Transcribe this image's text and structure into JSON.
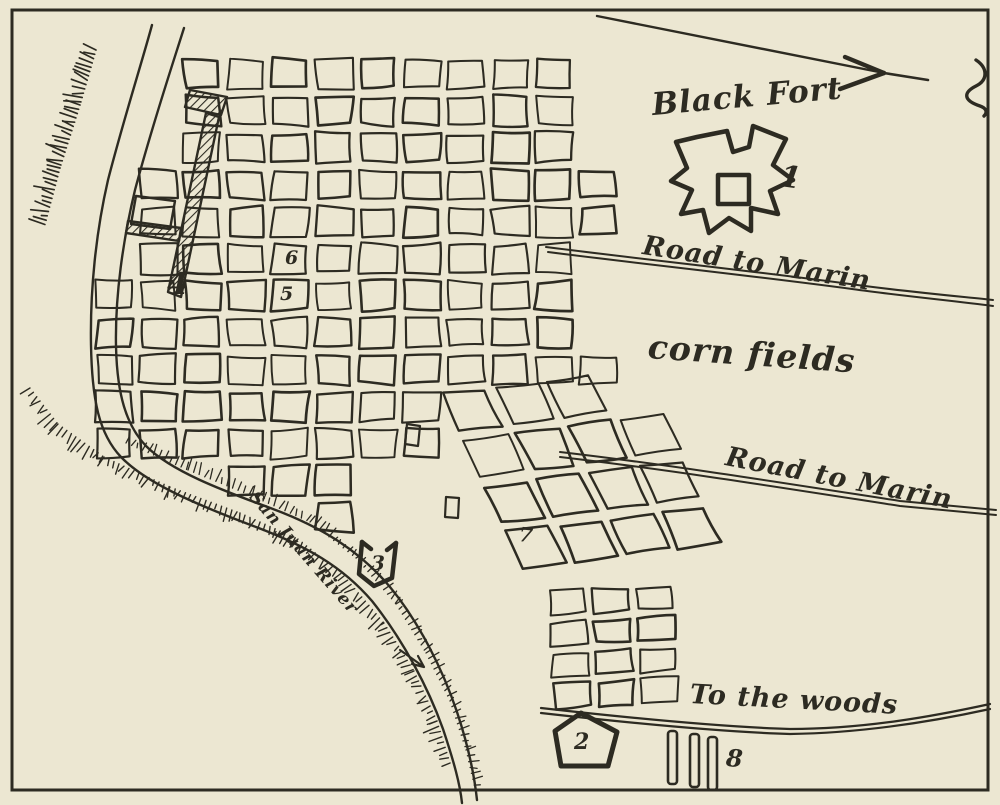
{
  "map": {
    "labels": {
      "black_fort": "Black Fort",
      "road_to_marin_upper": "Road to Marin",
      "road_to_marin_lower": "Road to Marin",
      "corn_fields": "corn fields",
      "to_the_woods": "To the woods",
      "river": "San Juan River"
    },
    "markers": {
      "m1": "1",
      "m2": "2",
      "m3": "3",
      "m4": "4",
      "m5": "5",
      "m6": "6",
      "m7": "7",
      "m8": "8"
    },
    "icons": {
      "direction_arrow": "northeast-arrow-icon",
      "script_glyph": "script-flourish-icon",
      "river_flow_arrow": "river-flow-arrow-icon"
    },
    "colors": {
      "paper": "#ece7d2",
      "ink": "#2d2b22"
    }
  }
}
